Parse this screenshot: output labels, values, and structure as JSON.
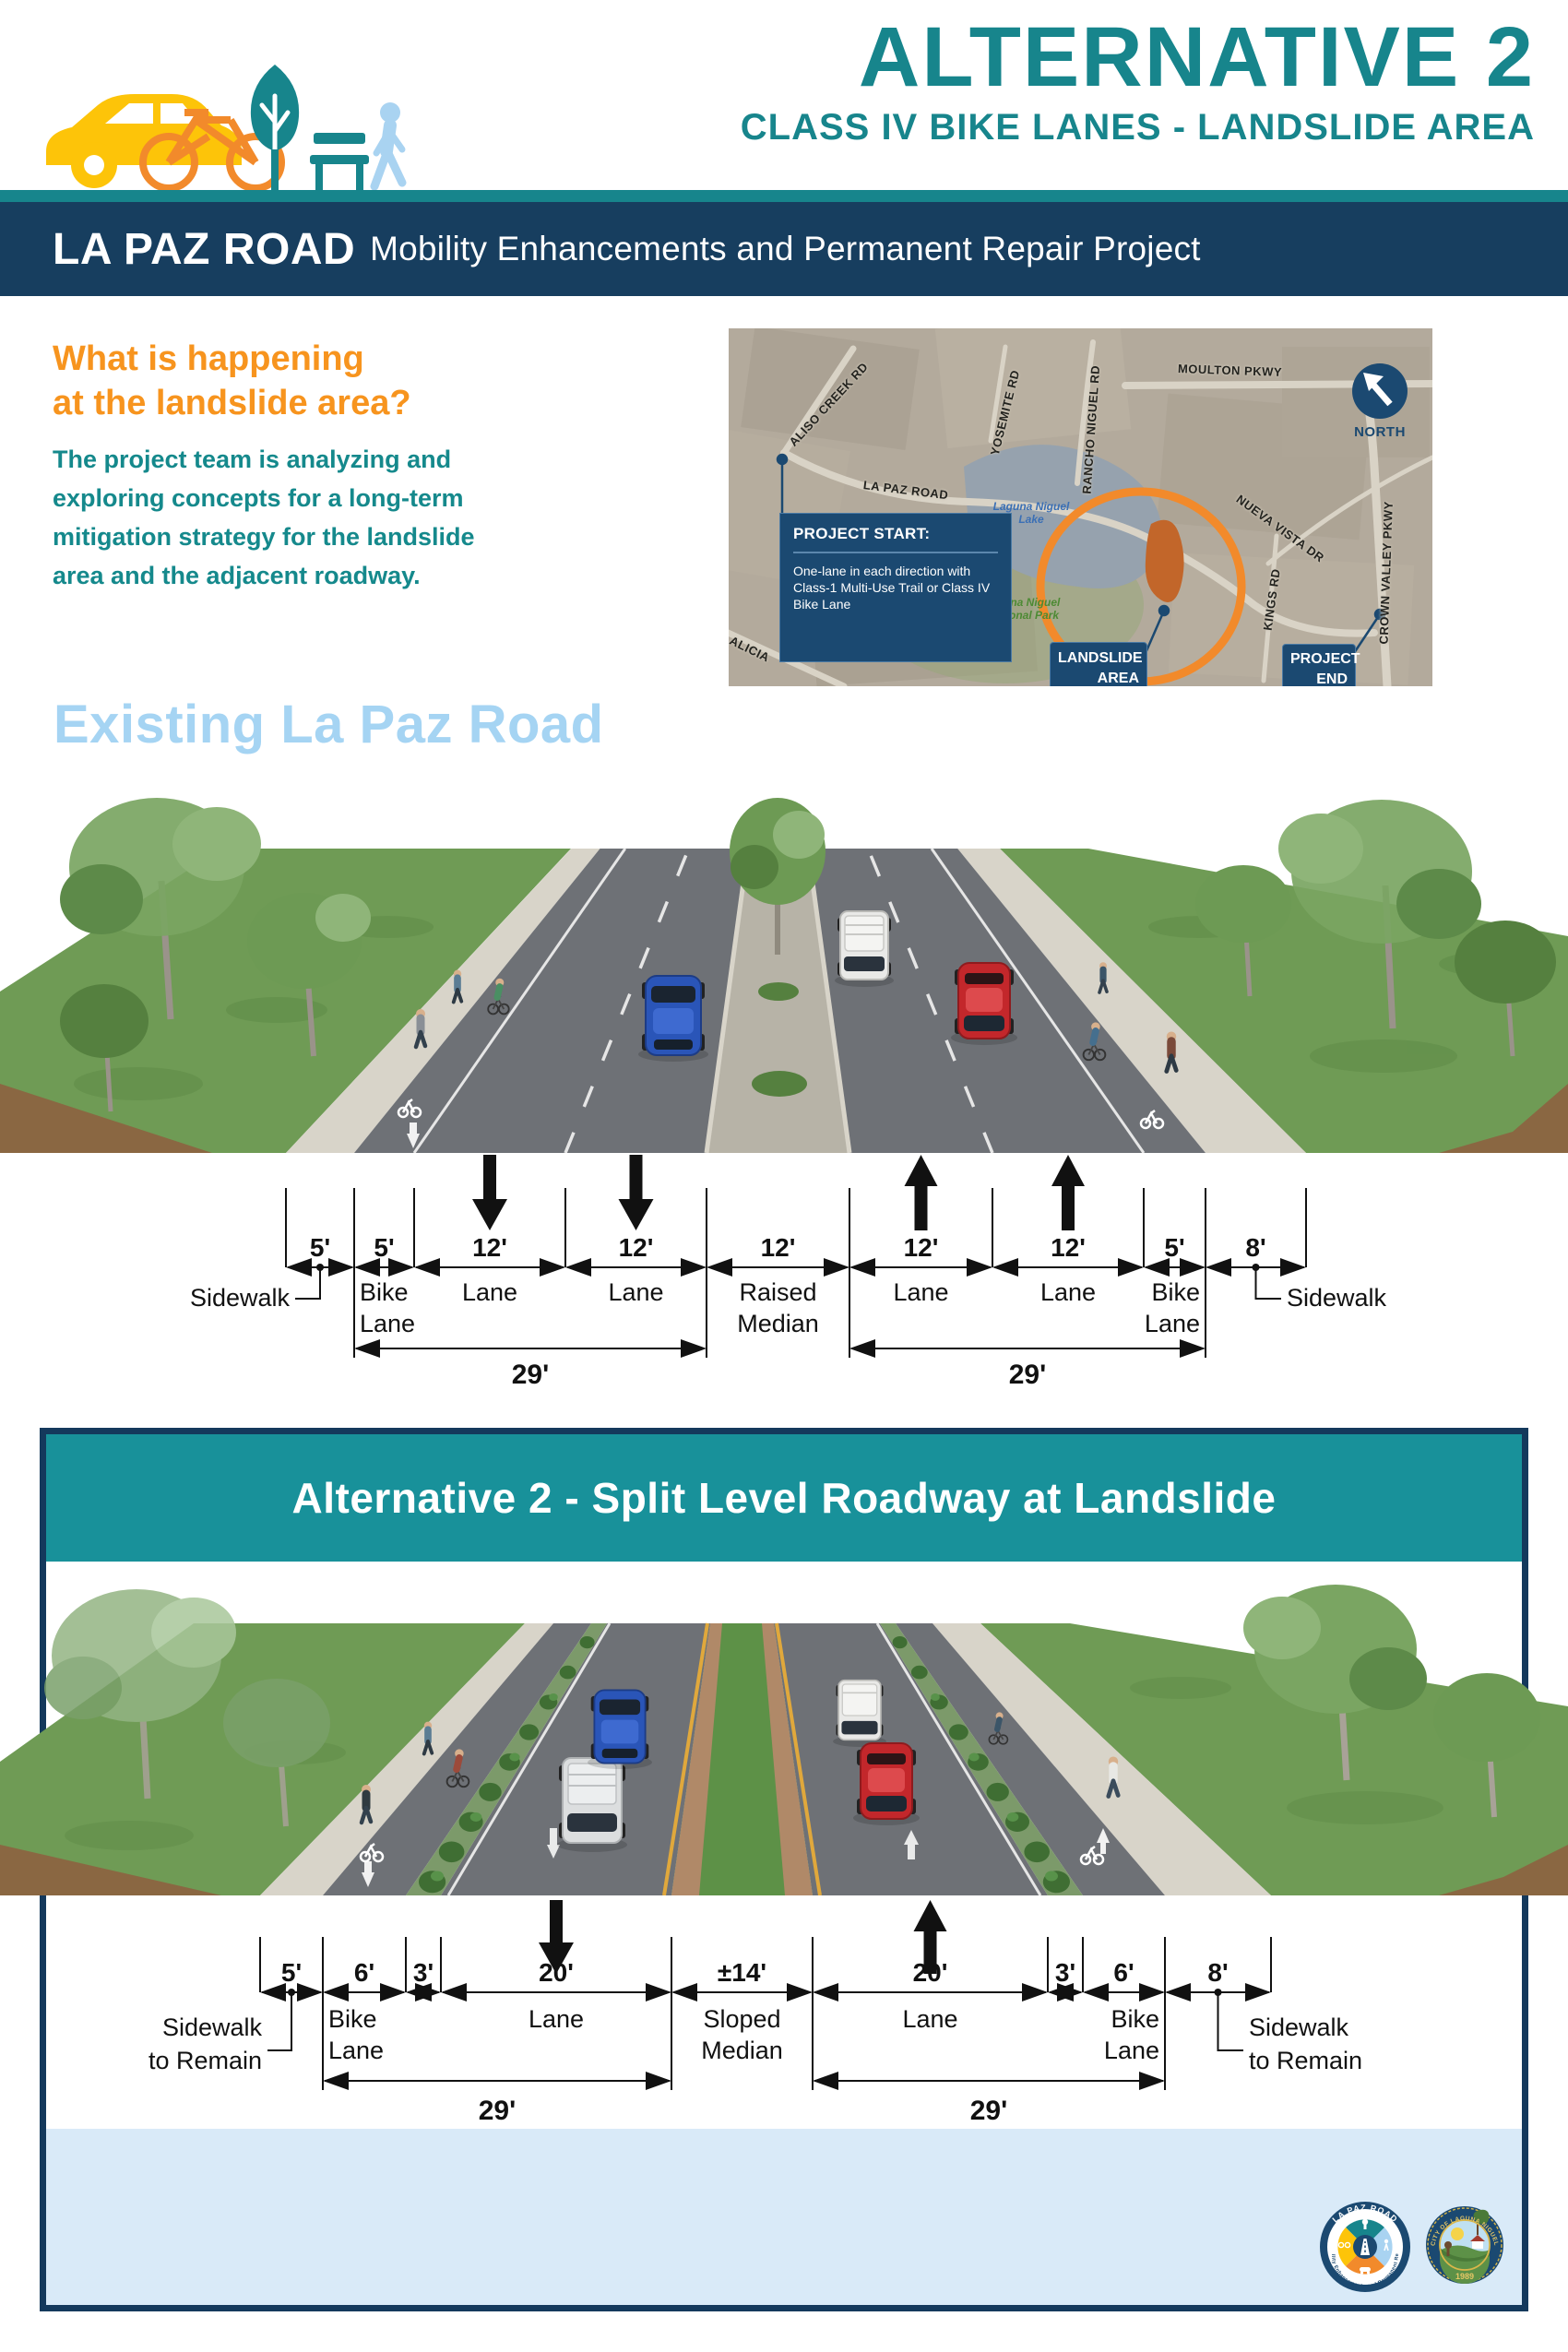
{
  "header": {
    "title": "ALTERNATIVE 2",
    "subtitle": "CLASS IV BIKE LANES - LANDSLIDE AREA"
  },
  "banner": {
    "road": "LA PAZ ROAD",
    "project": "Mobility Enhancements and Permanent Repair Project"
  },
  "intro": {
    "heading_line1": "What is happening",
    "heading_line2": "at the landslide area?",
    "body": "The project team is analyzing and exploring concepts for a long-term mitigation strategy for the landslide area and the adjacent roadway."
  },
  "map": {
    "north": "NORTH",
    "roads": [
      "ALISO CREEK RD",
      "YOSEMITE RD",
      "RANCHO NIGUEL RD",
      "MOULTON PKWY",
      "LA PAZ ROAD",
      "NUEVA VISTA DR",
      "KINGS RD",
      "CROWN VALLEY PKWY",
      "ALICIA"
    ],
    "lake": "Laguna Niguel Lake",
    "park": "Laguna Niguel Regional Park",
    "start_title": "PROJECT START:",
    "start_body": "One-lane in each direction with Class-1 Multi-Use Trail or Class IV Bike Lane",
    "landslide": "LANDSLIDE AREA",
    "end": "PROJECT END"
  },
  "existing": {
    "heading": "Existing La Paz Road",
    "dim_values": [
      "5'",
      "5'",
      "12'",
      "12'",
      "12'",
      "12'",
      "12'",
      "5'",
      "8'"
    ],
    "labels": {
      "sidewalk": "Sidewalk",
      "bike_1": "Bike",
      "bike_2": "Lane",
      "lane": "Lane",
      "median_1": "Raised",
      "median_2": "Median"
    },
    "span_left": "29'",
    "span_right": "29'"
  },
  "alternative": {
    "banner": "Alternative 2 - Split Level Roadway at Landslide",
    "dim_values": [
      "5'",
      "6'",
      "3'",
      "20'",
      "±14'",
      "20'",
      "3'",
      "6'",
      "8'"
    ],
    "labels": {
      "sidewalk_1": "Sidewalk",
      "sidewalk_2": "to Remain",
      "bike_1": "Bike",
      "bike_2": "Lane",
      "lane": "Lane",
      "median_1": "Sloped",
      "median_2": "Median"
    },
    "span_left": "29'",
    "span_right": "29'"
  },
  "footer": {
    "logo1_title": "LA PAZ ROAD",
    "logo1_sub": "Mobility Enhancements and Permanent Repair",
    "logo2_title": "CITY OF LAGUNA NIGUEL",
    "logo2_year": "1989"
  }
}
